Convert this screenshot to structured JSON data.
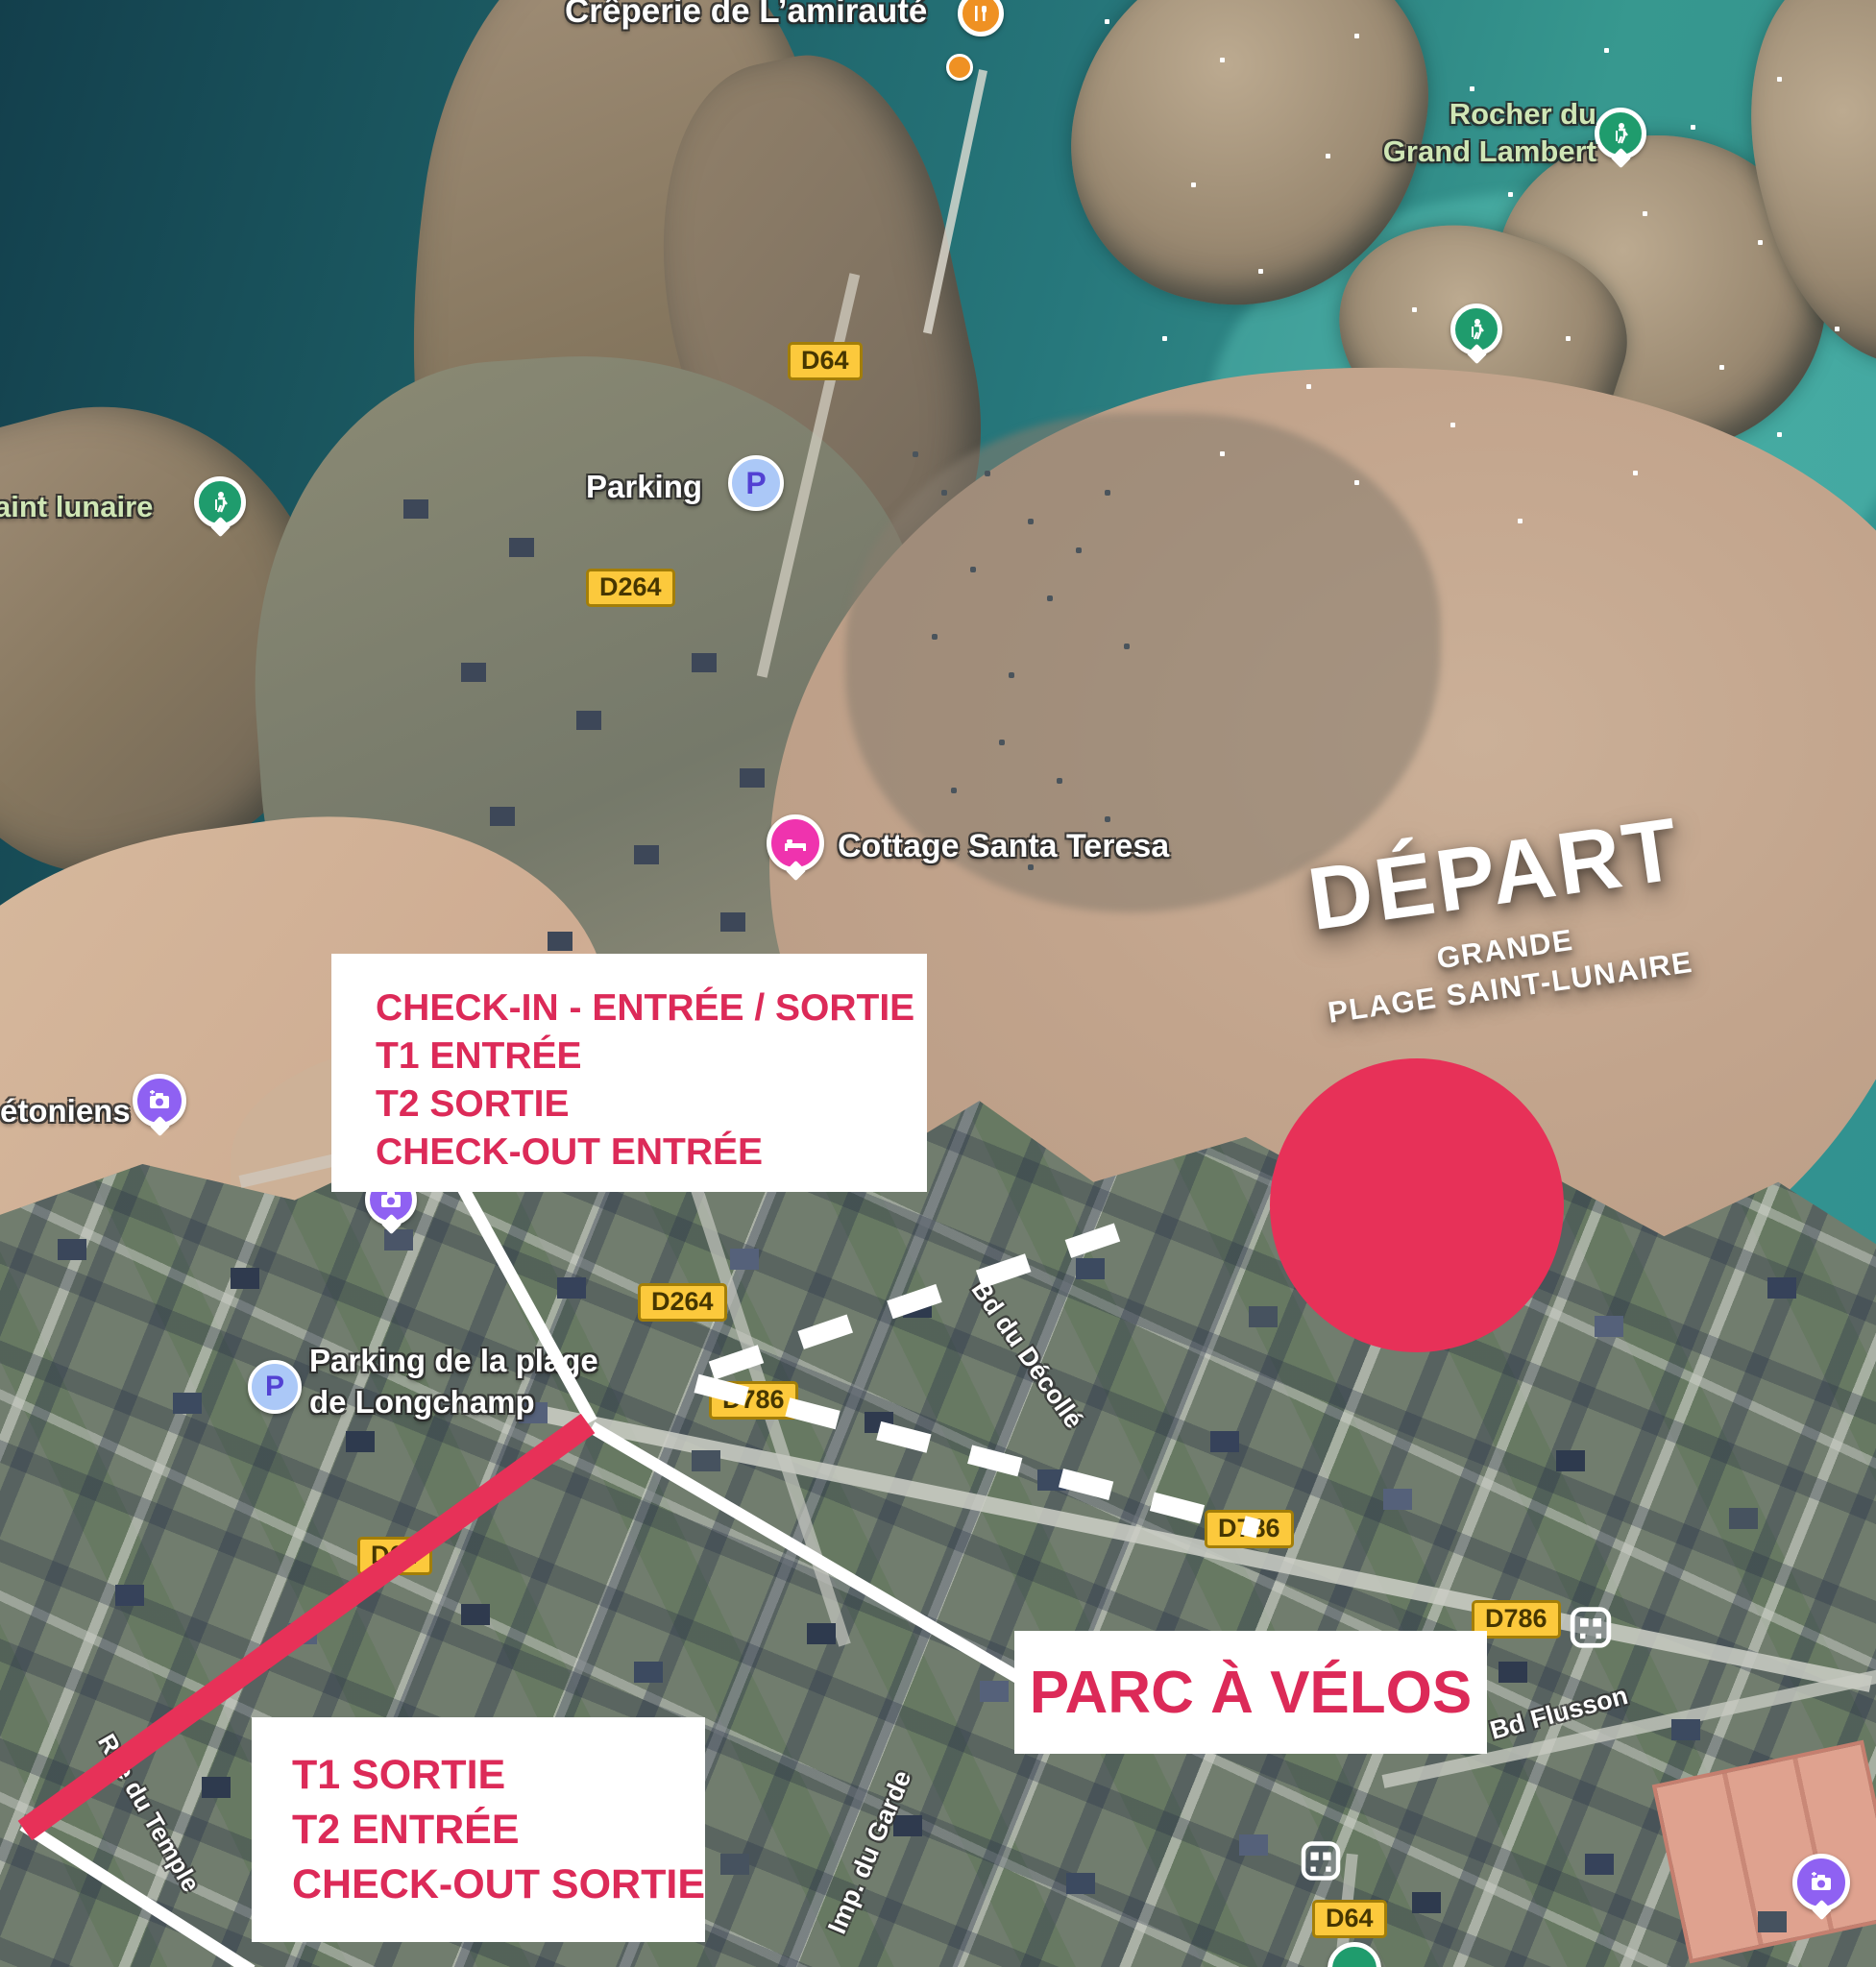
{
  "colors": {
    "accent_text": "#dc2a58",
    "shape_red": "#e73158",
    "box_bg": "#ffffff",
    "badge_bg": "#fcc93c",
    "badge_border": "#a37e08",
    "badge_text": "#463600",
    "green_label": "#cfe6b5",
    "pin_green": "#1f9c6d",
    "pin_purple": "#8f61f2",
    "pin_pink": "#ef33ae",
    "parking_blue": "#abc8f7",
    "parking_letter": "#5241d3",
    "poi_orange": "#ef9123"
  },
  "poi": {
    "creperie": "Crêperie de L’amirauté",
    "rocher_line1": "Rocher du",
    "rocher_line2": "Grand Lambert",
    "saint_lunaire": "aint lunaire",
    "parking": "Parking",
    "cottage": "Cottage Santa Teresa",
    "etoniens": "étoniens",
    "longchamp_line1": "Parking de la plage",
    "longchamp_line2": "de Longchamp",
    "p_glyph": "P"
  },
  "streets": {
    "decolle": "Bd du Décollé",
    "garde": "Imp. du Garde",
    "temple": "Rue du Temple",
    "flusson": "Bd Flusson"
  },
  "badges": {
    "d64_top": "D64",
    "d264_top": "D264",
    "d264_mid": "D264",
    "d786_mid": "D786",
    "d786_right": "D786",
    "d786_far": "D786",
    "d64_bottom": "D64",
    "d64_coast": "D64"
  },
  "depart": {
    "title": "DÉPART",
    "sub1": "GRANDE",
    "sub2": "PLAGE SAINT-LUNAIRE"
  },
  "boxes": {
    "checkin": {
      "line1": "CHECK-IN - ENTRÉE / SORTIE",
      "line2": "T1 ENTRÉE",
      "line3": "T2 SORTIE",
      "line4": "CHECK-OUT ENTRÉE"
    },
    "exit": {
      "line1": "T1 SORTIE",
      "line2": "T2 ENTRÉE",
      "line3": "CHECK-OUT SORTIE"
    },
    "bike": {
      "label": "PARC À VÉLOS"
    }
  },
  "icons": [
    "restaurant-icon",
    "hiking-icon",
    "parking-icon",
    "hotel-bed-icon",
    "photo-camera-icon",
    "bus-icon",
    "tennis-icon"
  ]
}
